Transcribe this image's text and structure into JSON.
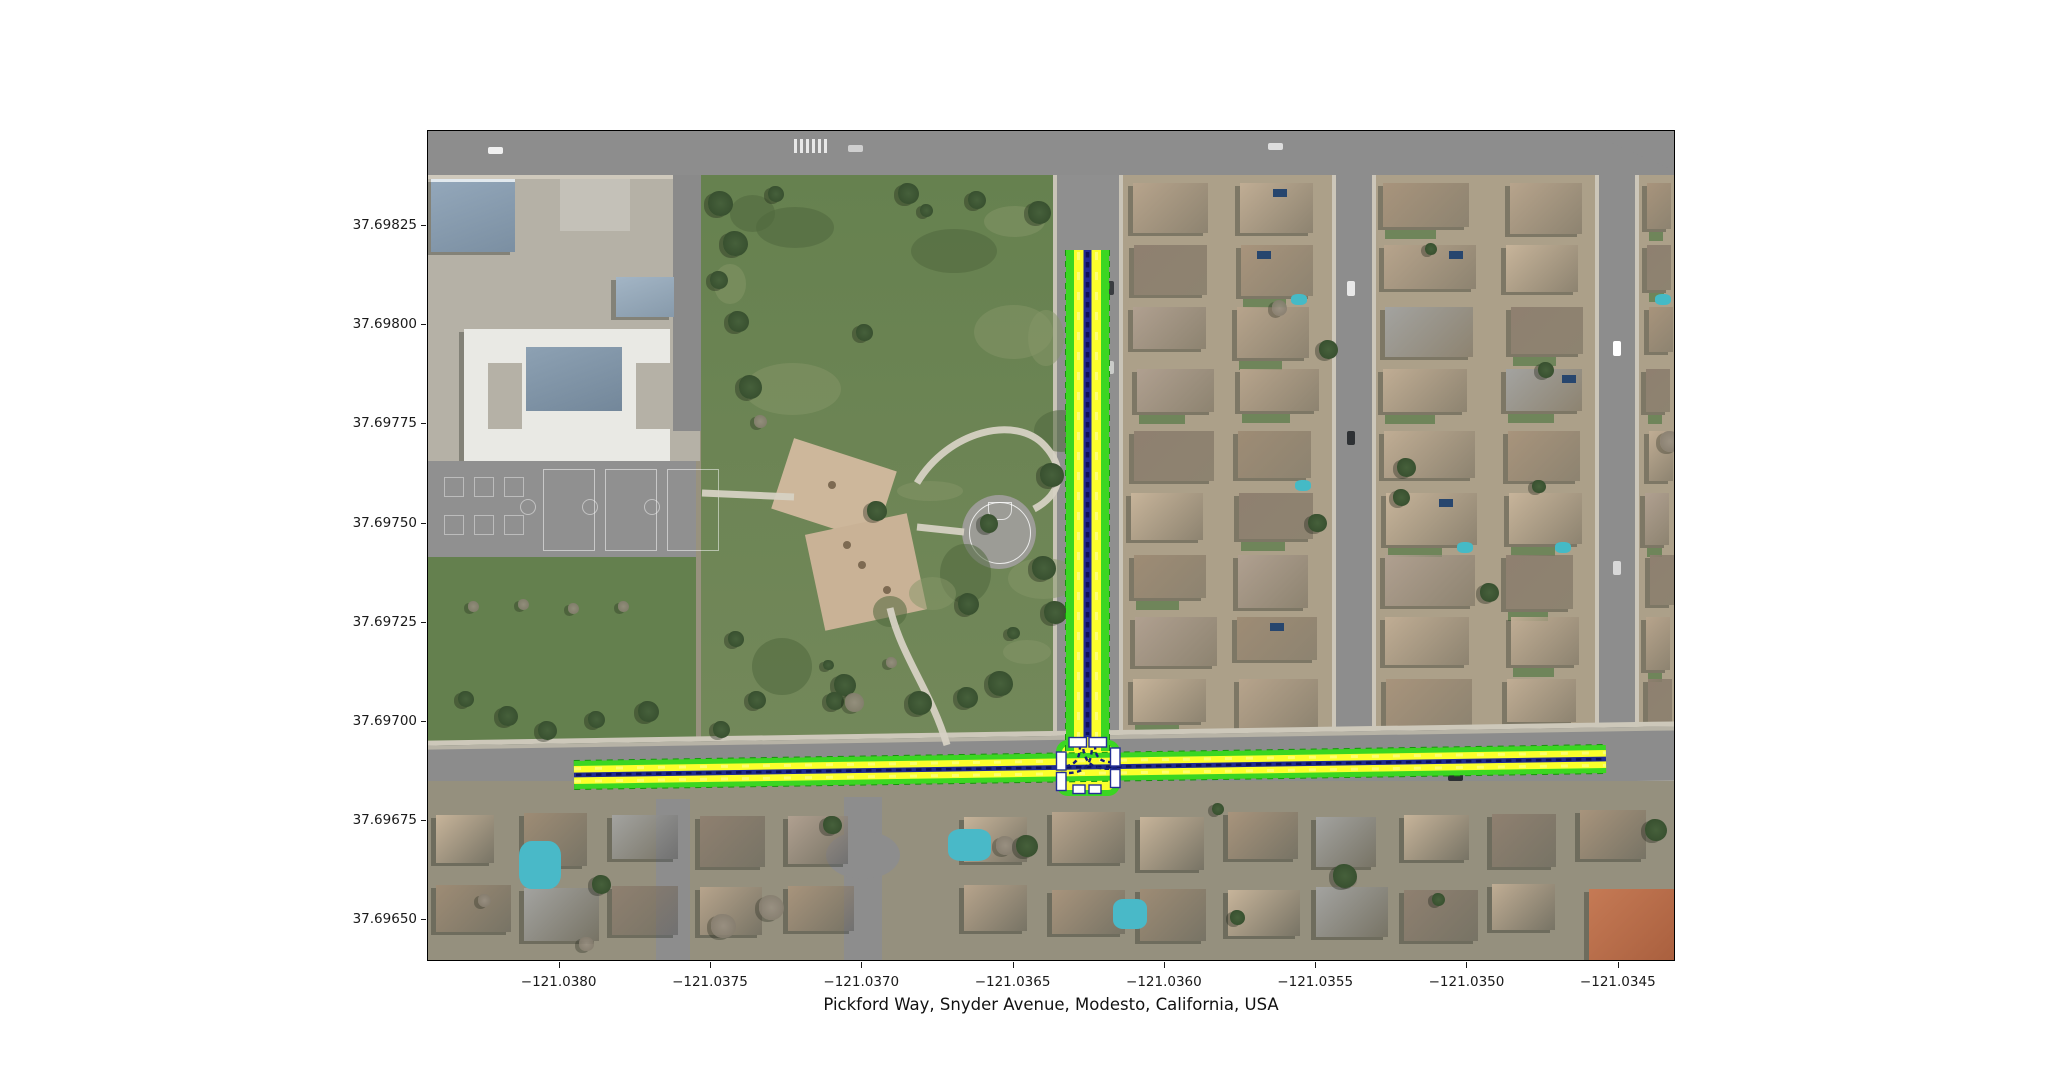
{
  "figure": {
    "title": "Pickford Way, Snyder Avenue, Modesto, California, USA"
  },
  "axes": {
    "x": {
      "ticks": [
        {
          "label": "−121.0380",
          "value": -121.038
        },
        {
          "label": "−121.0375",
          "value": -121.0375
        },
        {
          "label": "−121.0370",
          "value": -121.037
        },
        {
          "label": "−121.0365",
          "value": -121.0365
        },
        {
          "label": "−121.0360",
          "value": -121.036
        },
        {
          "label": "−121.0355",
          "value": -121.0355
        },
        {
          "label": "−121.0350",
          "value": -121.035
        },
        {
          "label": "−121.0345",
          "value": -121.0345
        }
      ]
    },
    "y": {
      "ticks": [
        {
          "label": "37.69825",
          "value": 37.69825
        },
        {
          "label": "37.69800",
          "value": 37.698
        },
        {
          "label": "37.69775",
          "value": 37.69775
        },
        {
          "label": "37.69750",
          "value": 37.6975
        },
        {
          "label": "37.69725",
          "value": 37.69725
        },
        {
          "label": "37.69700",
          "value": 37.697
        },
        {
          "label": "37.69675",
          "value": 37.69675
        },
        {
          "label": "37.69650",
          "value": 37.6965
        }
      ]
    }
  },
  "chart_data": {
    "type": "map",
    "title": "Pickford Way, Snyder Avenue, Modesto, California, USA",
    "basemap": "aerial imagery: school campus and park on the west, residential blocks east and south",
    "extent": {
      "lon_min": -121.038435,
      "lon_max": -121.034311,
      "lat_min": 37.696394,
      "lat_max": 37.69849
    },
    "highlighted_streets": [
      "Pickford Way",
      "Snyder Avenue"
    ],
    "roads": [
      {
        "id": "east-west-road",
        "lanes": 2,
        "from": {
          "lon": -121.037952,
          "lat": 37.696866
        },
        "to": {
          "lon": -121.034542,
          "lat": 37.696906
        }
      },
      {
        "id": "north-south-road",
        "lanes": 2,
        "from": {
          "lon": -121.036255,
          "lat": 37.69819
        },
        "to": {
          "lon": -121.036255,
          "lat": 37.696886
        }
      }
    ],
    "intersection": {
      "type": "T",
      "lon": -121.036255,
      "lat": 37.696886,
      "crosswalks": 4
    },
    "overlay_colors": {
      "road_edge": "#17950c",
      "road_fill": "#3bd622",
      "lane_fill": "#fbff2b",
      "centerline": "#202b92",
      "centerline_dash": "#0e1257",
      "crosswalk": "#ffffff",
      "crosswalk_outline": "#232f96"
    }
  }
}
